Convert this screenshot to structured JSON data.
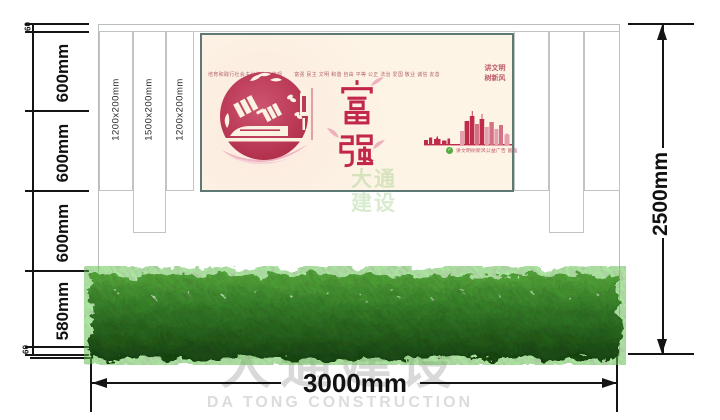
{
  "drawing": {
    "dim_left": [
      "60",
      "600mm",
      "600mm",
      "600mm",
      "580mm",
      "60"
    ],
    "dim_right": "2500mm",
    "dim_bottom": "3000mm",
    "panel_labels": [
      "1200x200mm",
      "1500x200mm",
      "1200x200mm"
    ]
  },
  "poster": {
    "header_left": "培育和践行社会主义核心价值观",
    "header_values": "富强 民主 文明 和谐 自由 平等 公正 法治 爱国 敬业 诚信 友善",
    "slogan_line1": "讲文明",
    "slogan_line2": "树新风",
    "main_char_top": "富",
    "main_char_bottom": "强",
    "caption": "讲文明树新风公益广告 富强"
  },
  "watermark": {
    "cn": "大通建设",
    "en": "DA TONG CONSTRUCTION",
    "logo_line1": "大通",
    "logo_line2": "建设"
  },
  "colors": {
    "dimension_black": "#141414",
    "crimson": "#bf2b4a",
    "light_pink": "#e9a9b6",
    "poster_background": "#fdf4e6",
    "poster_frame": "#5e7876",
    "hedge_green": "#4e8f3e",
    "watermark_gray": "#d9d9d9",
    "logo_green": "#7fbf63"
  }
}
